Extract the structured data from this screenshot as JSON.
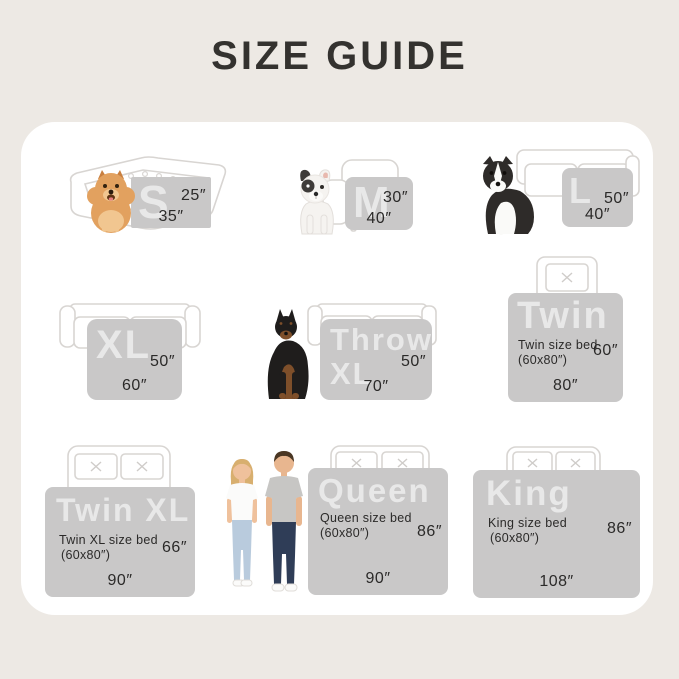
{
  "page": {
    "title": "SIZE GUIDE",
    "colors": {
      "background": "#EDE9E4",
      "card": "#FFFFFF",
      "swatch": "#C9C8C8",
      "swatch_letter": "#DEDDDD",
      "text": "#2B2A29",
      "furniture_outline": "#D8D5D2"
    }
  },
  "sizes": [
    {
      "key": "s",
      "label": "S",
      "height": "25″",
      "width": "35″",
      "furniture": "pet-bed",
      "companion": "pomeranian"
    },
    {
      "key": "m",
      "label": "M",
      "height": "30″",
      "width": "40″",
      "furniture": "armchair",
      "companion": "french-bulldog"
    },
    {
      "key": "l",
      "label": "L",
      "height": "50″",
      "width": "40″",
      "furniture": "sofa",
      "companion": "border-collie"
    },
    {
      "key": "xl",
      "label": "XL",
      "height": "50″",
      "width": "60″",
      "furniture": "sofa",
      "companion": ""
    },
    {
      "key": "throw_xl",
      "label": "Throw\nXL",
      "height": "50″",
      "width": "70″",
      "furniture": "sofa",
      "companion": "doberman"
    },
    {
      "key": "twin",
      "label": "Twin",
      "sublabel": "Twin size bed",
      "subdim": "(60x80″)",
      "height": "60″",
      "width": "80″",
      "furniture": "bed-one-pillow"
    },
    {
      "key": "twin_xl",
      "label": "Twin XL",
      "sublabel": "Twin XL size bed",
      "subdim": "(60x80″)",
      "height": "66″",
      "width": "90″",
      "furniture": "bed-two-pillows"
    },
    {
      "key": "queen",
      "label": "Queen",
      "sublabel": "Queen size bed",
      "subdim": "(60x80″)",
      "height": "86″",
      "width": "90″",
      "furniture": "bed-two-pillows",
      "companion": "couple"
    },
    {
      "key": "king",
      "label": "King",
      "sublabel": "King size bed",
      "subdim": "(60x80″)",
      "height": "86″",
      "width": "108″",
      "furniture": "bed-two-pillows"
    }
  ]
}
